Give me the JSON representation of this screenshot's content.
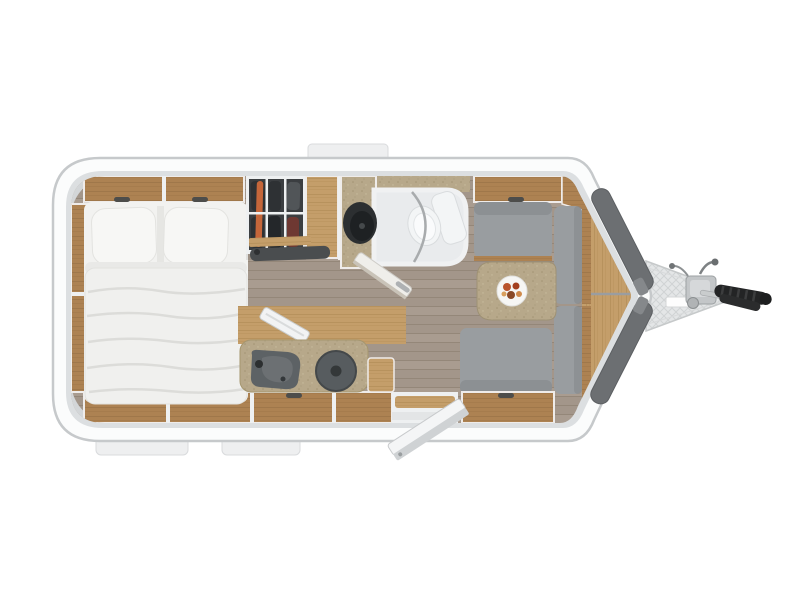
{
  "meta": {
    "description": "Top-down 3D rendered floor plan of a single-axle travel caravan on a white background, hitch/drawbar pointing right",
    "view": "top-down",
    "background": "white"
  },
  "palette": {
    "page": "#ffffff",
    "bodyFill": "#fbfcfc",
    "bodyStroke": "#c6c9cb",
    "liner": "#dcdfe1",
    "innerBase": "#eeedeb",
    "cornerMold": "#d3d6d8",
    "wood": "#ad8252",
    "woodGrain": "#8e693f",
    "woodLight": "#c49e6a",
    "woodLightGrain": "#a9854f",
    "floor": "#a3968a",
    "floorLine": "#948779",
    "floorLight": "#b1a496",
    "mattress": "#f2f2f0",
    "mattressShade": "#dcdcd9",
    "pillow": "#f7f7f5",
    "cushion": "#999da0",
    "cushionDark": "#83878a",
    "counter": "#b7a88a",
    "counterDark": "#a5966f",
    "wardrobeBack": "#3b3e41",
    "clothes": "#2e3134",
    "orangeGarment": "#c5663a",
    "darkFixture": "#575c5f",
    "fixtureDeep": "#343839",
    "bathFloor": "#e9ebed",
    "toilet": "#f3f5f6",
    "nosePanel": "#6c6f72",
    "metal": "#c3c6c8",
    "metalDark": "#9da1a3",
    "hitchBlack": "#232425",
    "whiteTrim": "#eef0f1",
    "plate": "#f6f6f4",
    "tabFill": "#eeeff0",
    "tabStroke": "#d9dbdd",
    "drawbarPlate": "#e4e6e7",
    "drawbarHatch": "#d0d3d4",
    "handleDark": "#4d4d4b",
    "food1": "#b9542c",
    "food2": "#a33f1f",
    "food3": "#8a4a28",
    "food4": "#cf8a4c",
    "food5": "#d9a05e"
  },
  "exterior": {
    "shell": "white rounded shell with light gray trim, pointed hexagonal nose on the right",
    "roof_tab": "rooflight frame tab on the top edge",
    "service_flaps": [
      "left service flap below body",
      "right service flap below body"
    ],
    "nose_panels": [
      "upper dark gray front panel",
      "lower dark gray front panel"
    ],
    "drawbar": {
      "plate": "triangular checker-plate drawbar cover",
      "coupling": "hitch coupling head with release lever",
      "handle": "black ribbed grip handle",
      "jockey_wheel": "jockey wheel crank knob"
    }
  },
  "rooms": {
    "bedroom": {
      "position": "rear (left end)",
      "features": [
        "french double bed with duvet",
        "pillow left",
        "pillow right",
        "overhead lockers above headboard (2 doors)",
        "rear wall shelf column",
        "under-window cabinets along bottom wall (3 sections)"
      ]
    },
    "wardrobe": {
      "position": "top wall, next to bed",
      "features": [
        "open wardrobe with hanging clothes viewed from above",
        "one orange garment",
        "slatted wooden sideboard",
        "dark shoe mat / step below"
      ]
    },
    "bathroom": {
      "position": "top center",
      "features": [
        "speckled vanity counter",
        "round dark washbasin",
        "toilet with cistern",
        "curved shower rail",
        "open bathroom door swung into corridor"
      ]
    },
    "kitchen": {
      "position": "bottom center",
      "features": [
        "wood worktop against wall",
        "sculpted dark sink with tap hole",
        "round single hob with lid knob",
        "side extension cabinet",
        "drainer board leaning on worktop",
        "drawer cabinets below"
      ]
    },
    "dinette": {
      "position": "front (right end)",
      "features": [
        "U-shaped seating with gray cushions: top bench, front bench upper, front bench lower, bottom bench",
        "overhead locker above top bench",
        "corner locker at front top",
        "table with rounded left edge",
        "plate with food on table",
        "wooden base cabinet under bottom bench"
      ]
    },
    "entry": {
      "position": "bottom wall right of kitchen",
      "features": [
        "entrance doorway with threshold step",
        "entry door shown open, swung outside"
      ]
    },
    "front_storage": {
      "position": "inside the nose",
      "features": [
        "tapered wooden front shelf",
        "metal rail across shelf"
      ]
    },
    "flooring": "gray-brown wood plank flooring in the corridor and living area"
  }
}
